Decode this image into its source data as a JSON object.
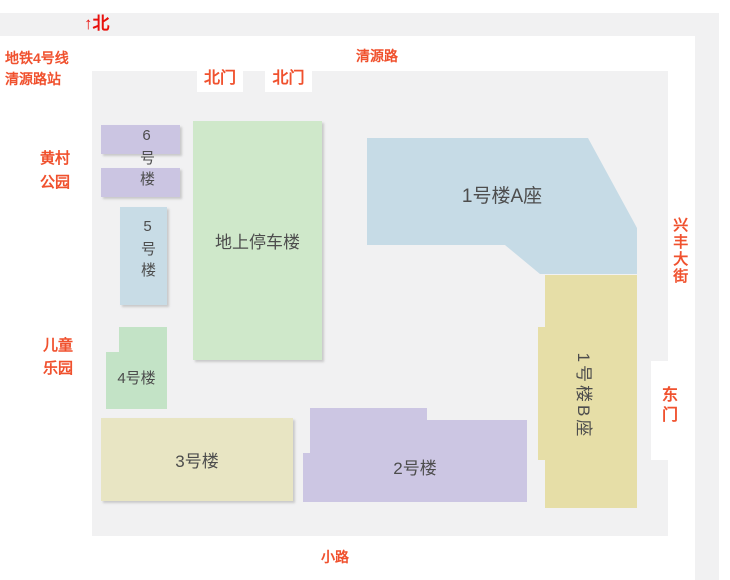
{
  "map": {
    "north_indicator": "↑北",
    "north_color": "#e8100c",
    "label_color": "#f0512e",
    "road_color": "#f1f1f2",
    "area_color": "#f1f1f2",
    "building_text_color": "#4d4d4d"
  },
  "roads": {
    "top": "清源路",
    "right": "兴丰大街",
    "bottom": "小路"
  },
  "landmarks": {
    "subway": [
      "地铁4号线",
      "清源路站"
    ],
    "park": [
      "黄村",
      "公园"
    ],
    "playground": [
      "儿童",
      "乐园"
    ]
  },
  "gates": {
    "north1": "北门",
    "north2": "北门",
    "east": "东门"
  },
  "buildings": {
    "b6": {
      "label": "6号楼",
      "color": "#cbc5e2"
    },
    "b5": {
      "label": "5号楼",
      "color": "#c8dce6"
    },
    "parking": {
      "label": "地上停车楼",
      "color": "#cfe8ca"
    },
    "b4": {
      "label": "4号楼",
      "color": "#c3e3c6"
    },
    "b3": {
      "label": "3号楼",
      "color": "#e8e5c3"
    },
    "b2": {
      "label": "2号楼",
      "color": "#ccc6e3"
    },
    "b1a": {
      "label": "1号楼A座",
      "color": "#c6dbe6"
    },
    "b1b": {
      "label": "1号楼B座",
      "color": "#e6dea7"
    }
  }
}
